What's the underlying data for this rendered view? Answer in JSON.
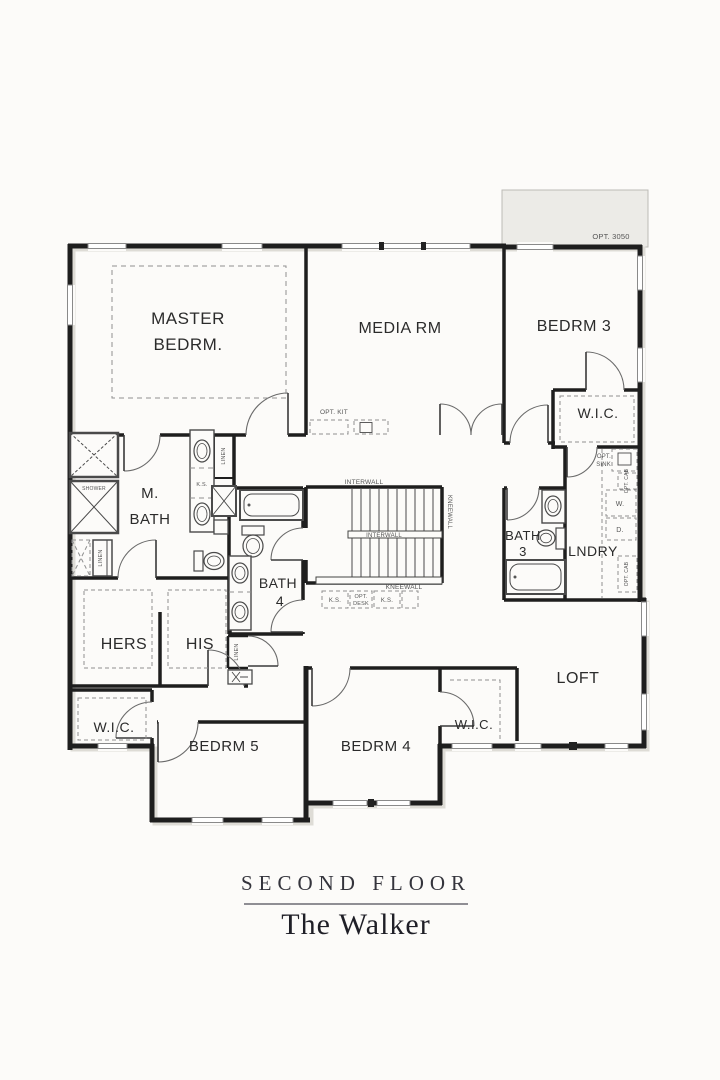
{
  "title_block": {
    "floor_label": "SECOND FLOOR",
    "plan_name": "The Walker"
  },
  "colors": {
    "paper": "#fcfbf9",
    "wall": "#1e1e1e",
    "annotation_text": "#474747",
    "optional_area_fill": "#ecebe7",
    "dashed_line": "#8f8f8f"
  },
  "rooms": {
    "master_bedroom": {
      "line1": "MASTER",
      "line2": "BEDRM."
    },
    "media_room": {
      "label": "MEDIA RM"
    },
    "bedroom_3": {
      "label": "BEDRM 3"
    },
    "bedroom_3_wic": {
      "label": "W.I.C."
    },
    "bath_3": {
      "line1": "BATH",
      "line2": "3"
    },
    "laundry": {
      "label": "LNDRY"
    },
    "master_bath": {
      "line1": "M.",
      "line2": "BATH"
    },
    "bath_4": {
      "line1": "BATH",
      "line2": "4"
    },
    "hers_closet": {
      "label": "HERS"
    },
    "his_closet": {
      "label": "HIS"
    },
    "bedroom_5_wic": {
      "label": "W.I.C."
    },
    "bedroom_5": {
      "label": "BEDRM 5"
    },
    "bedroom_4": {
      "label": "BEDRM 4"
    },
    "bedroom_4_wic": {
      "label": "W.I.C."
    },
    "loft": {
      "label": "LOFT"
    }
  },
  "annotations": {
    "opt_3050": "OPT. 3050",
    "opt_kit": "OPT. KIT",
    "interwall_top": "INTERWALL",
    "interwall_mid": "INTERWALL",
    "kneewall_right": "KNEEWALL",
    "kneewall_bottom": "KNEEWALL",
    "ks_understair_left": "K.S.",
    "opt_desk_line1": "OPT.",
    "opt_desk_line2": "DESK",
    "ks_understair_right": "K.S.",
    "ks_master_vanity": "K.S.",
    "opt_sink_line1": "OPT.",
    "opt_sink_line2": "SINK",
    "opt_cab_upper": "OPT. CAB",
    "opt_cab_lower": "OPT. CAB",
    "washer": "W.",
    "dryer": "D.",
    "shower": "SHOWER",
    "linen_master": "LINEN",
    "linen_left": "LINEN",
    "linen_hall": "LINEN"
  }
}
